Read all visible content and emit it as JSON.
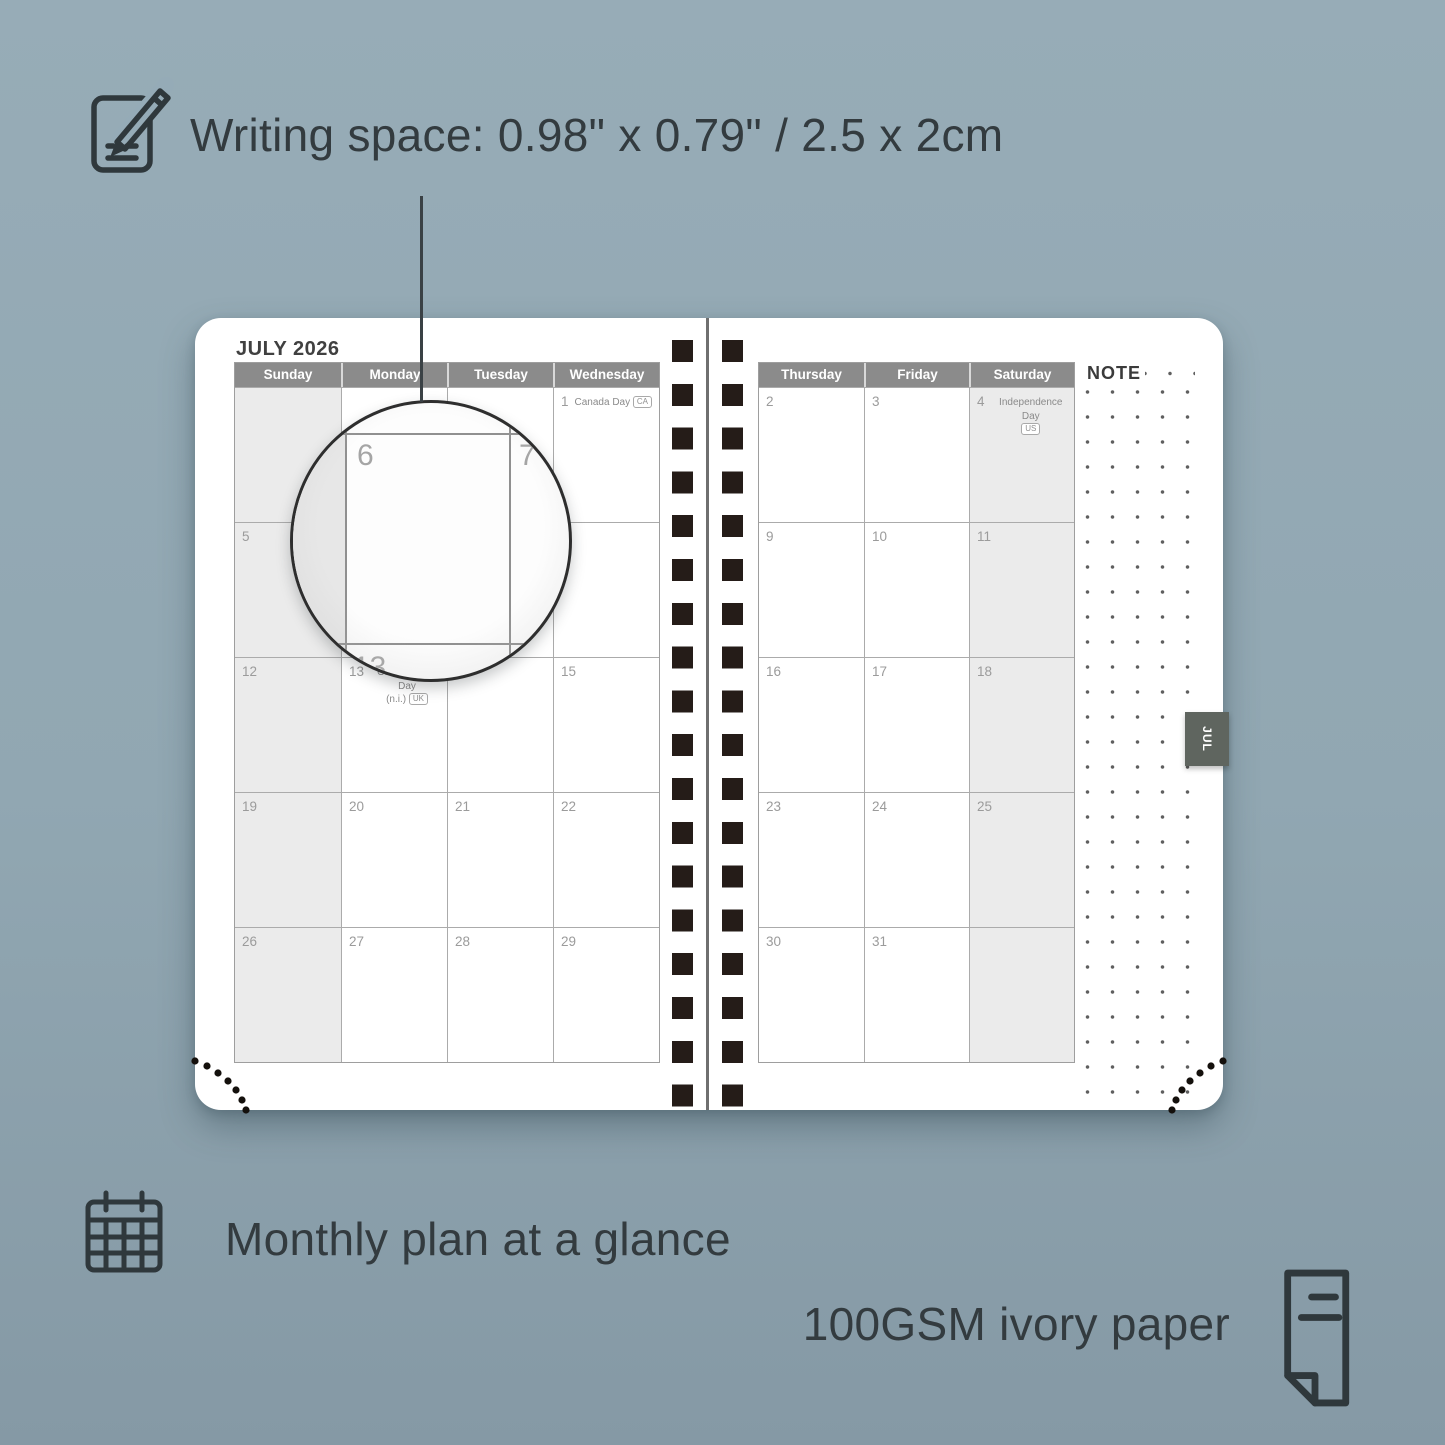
{
  "hero": {
    "writing_space_label": "Writing space: 0.98\" x 0.79\" / 2.5 x 2cm"
  },
  "features": [
    {
      "icon": "calendar-grid-icon",
      "label": "Monthly plan at a glance"
    },
    {
      "icon": "paper-sheet-icon",
      "label": "100GSM ivory paper"
    }
  ],
  "planner": {
    "month_title": "JULY 2026",
    "note_label": "NOTE",
    "month_tab": "JUL",
    "pages": [
      {
        "side": "left",
        "weekdays": [
          "Sunday",
          "Monday",
          "Tuesday",
          "Wednesday"
        ],
        "shaded_col": 0,
        "rows": [
          [
            {
              "d": ""
            },
            {
              "d": ""
            },
            {
              "d": ""
            },
            {
              "d": "1",
              "h1": "Canada Day",
              "badge": "CA",
              "badgeLine": 1
            }
          ],
          [
            {
              "d": "5"
            },
            {
              "d": "6"
            },
            {
              "d": "7"
            },
            {
              "d": "8"
            }
          ],
          [
            {
              "d": "12"
            },
            {
              "d": "13",
              "h1": "Orangemen's Day",
              "h2": "(n.i.)",
              "badge": "UK",
              "badgeLine": 2
            },
            {
              "d": "14"
            },
            {
              "d": "15"
            }
          ],
          [
            {
              "d": "19"
            },
            {
              "d": "20"
            },
            {
              "d": "21"
            },
            {
              "d": "22"
            }
          ],
          [
            {
              "d": "26"
            },
            {
              "d": "27"
            },
            {
              "d": "28"
            },
            {
              "d": "29"
            }
          ]
        ]
      },
      {
        "side": "right",
        "weekdays": [
          "Thursday",
          "Friday",
          "Saturday"
        ],
        "shaded_col": 2,
        "rows": [
          [
            {
              "d": "2"
            },
            {
              "d": "3"
            },
            {
              "d": "4",
              "h1": "Independence Day",
              "badge": "US",
              "badgeLine": 2
            }
          ],
          [
            {
              "d": "9"
            },
            {
              "d": "10"
            },
            {
              "d": "11"
            }
          ],
          [
            {
              "d": "16"
            },
            {
              "d": "17"
            },
            {
              "d": "18"
            }
          ],
          [
            {
              "d": "23"
            },
            {
              "d": "24"
            },
            {
              "d": "25"
            }
          ],
          [
            {
              "d": "30"
            },
            {
              "d": "31"
            },
            {
              "d": ""
            }
          ]
        ]
      }
    ],
    "lens": {
      "magnified_day": "6",
      "next_day": "7",
      "below_day": "13"
    }
  },
  "colors": {
    "background": "#91a7b2",
    "page": "#ffffff",
    "header_gray": "#8b8b8b",
    "weekend_gray": "#ebebeb",
    "binding_black": "#251c18",
    "tab_gray": "#5f655f",
    "annotation_text": "#333b3f"
  }
}
